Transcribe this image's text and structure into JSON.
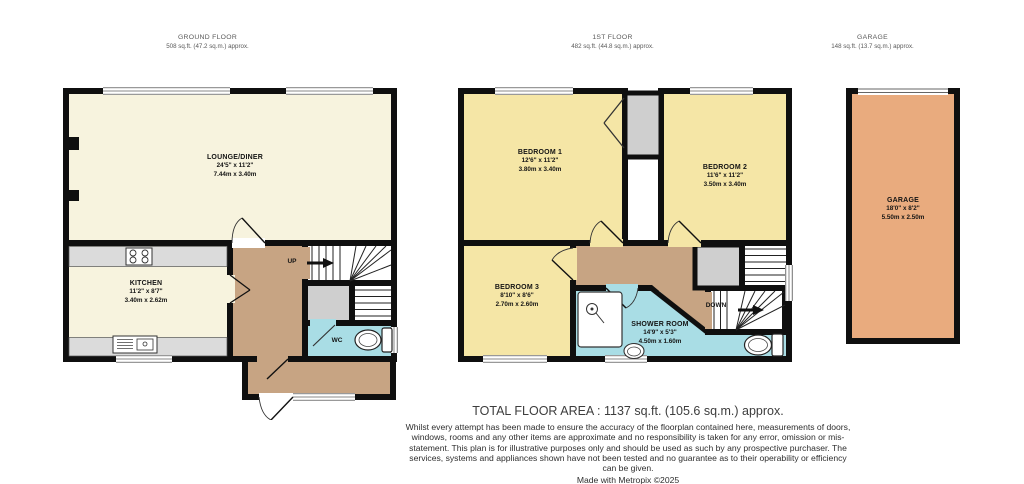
{
  "floors": {
    "ground": {
      "title": "GROUND FLOOR",
      "area": "508 sq.ft. (47.2 sq.m.) approx.",
      "stairs_label": "UP",
      "rooms": {
        "lounge": {
          "name": "LOUNGE/DINER",
          "size_imperial": "24'5\" x 11'2\"",
          "size_metric": "7.44m x 3.40m"
        },
        "kitchen": {
          "name": "KITCHEN",
          "size_imperial": "11'2\" x 8'7\"",
          "size_metric": "3.40m x 2.62m"
        },
        "wc": {
          "name": "WC"
        }
      }
    },
    "first": {
      "title": "1ST FLOOR",
      "area": "482 sq.ft. (44.8 sq.m.) approx.",
      "stairs_label": "DOWN",
      "rooms": {
        "bedroom1": {
          "name": "BEDROOM 1",
          "size_imperial": "12'6\" x 11'2\"",
          "size_metric": "3.80m x 3.40m"
        },
        "bedroom2": {
          "name": "BEDROOM 2",
          "size_imperial": "11'6\" x 11'2\"",
          "size_metric": "3.50m x 3.40m"
        },
        "bedroom3": {
          "name": "BEDROOM 3",
          "size_imperial": "8'10\" x 8'6\"",
          "size_metric": "2.70m x 2.60m"
        },
        "shower": {
          "name": "SHOWER ROOM",
          "size_imperial": "14'9\" x 5'3\"",
          "size_metric": "4.50m x 1.60m"
        }
      }
    },
    "garage": {
      "title": "GARAGE",
      "area": "148 sq.ft. (13.7 sq.m.) approx.",
      "rooms": {
        "garage": {
          "name": "GARAGE",
          "size_imperial": "18'0\" x 8'2\"",
          "size_metric": "5.50m x 2.50m"
        }
      }
    }
  },
  "footer": {
    "total_area": "TOTAL FLOOR AREA : 1137 sq.ft. (105.6 sq.m.) approx.",
    "disclaimer": "Whilst every attempt has been made to ensure the accuracy of the floorplan contained here, measurements of doors, windows, rooms and any other items are approximate and no responsibility is taken for any error, omission or mis-statement. This plan is for illustrative purposes only and should be used as such by any prospective purchaser. The services, systems and appliances shown have not been tested and no guarantee as to their operability or efficiency can be given.",
    "credit": "Made with Metropix ©2025"
  },
  "colors": {
    "wall": "#0f0f0f",
    "room_cream": "#F7F3DE",
    "room_yellow": "#F5E6A6",
    "hall_brown": "#C7A483",
    "wet_blue": "#A9DDE5",
    "cupboard_gray": "#CFCFCF",
    "garage_orange": "#E9AB7E"
  }
}
